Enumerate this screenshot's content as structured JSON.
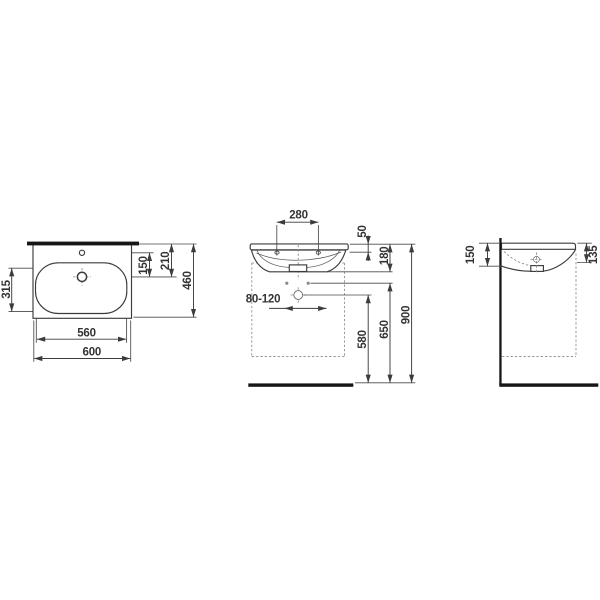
{
  "drawing_type": "washbasin-dimension-drawing",
  "colors": {
    "background": "#ffffff",
    "line": "#3c3c3c",
    "heavy_line": "#161616",
    "dashed_line": "#868686",
    "text": "#333333"
  },
  "views": {
    "plan": {
      "basin_depth": "315",
      "overflow_to_tap": "150",
      "edge_to_tap": "210",
      "total_depth": "460",
      "basin_width": "560",
      "total_width": "600"
    },
    "front": {
      "hole_spacing": "280",
      "rim_to_holes": "50",
      "rim_to_bottom": "180",
      "drain_offset_range": "80-120",
      "floor_to_drain": "580",
      "floor_to_fixing": "650",
      "floor_to_rim": "900"
    },
    "side": {
      "rear_thickness": "150",
      "front_thickness": "135"
    }
  }
}
